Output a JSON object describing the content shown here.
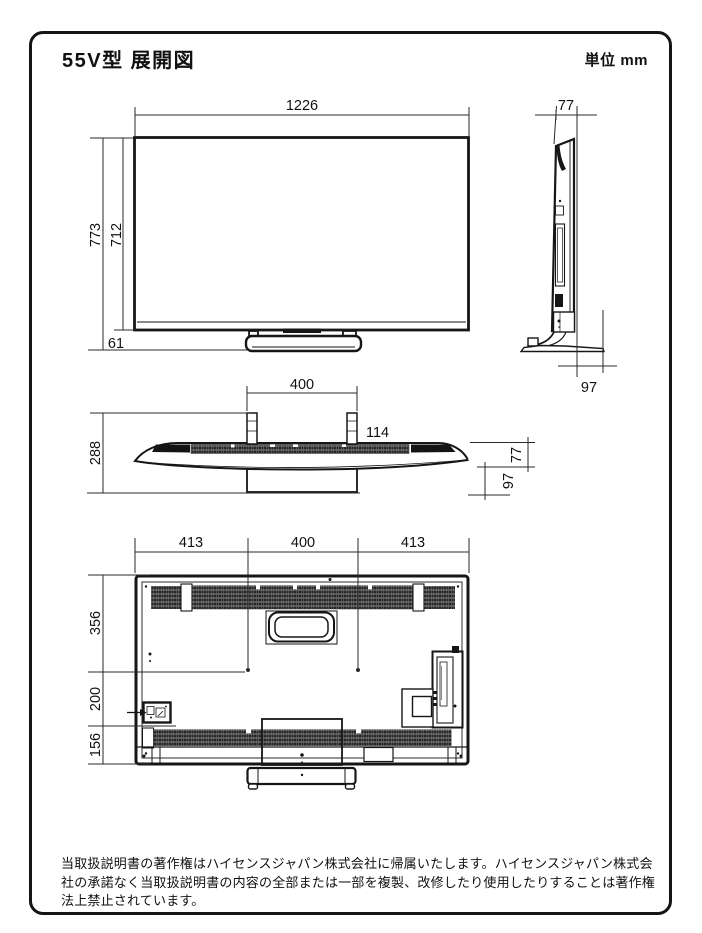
{
  "title": "55V型 展開図",
  "unit_label": "単位 mm",
  "front_view": {
    "width_mm": "1226",
    "total_height_mm": "773",
    "screen_height_mm": "712",
    "stand_gap_mm": "61"
  },
  "side_view": {
    "depth_mm": "77",
    "base_depth_mm": "97"
  },
  "top_view": {
    "stand_width_mm": "400",
    "total_depth_mm": "288",
    "neck_offset_mm": "114",
    "panel_depth_mm": "77",
    "base_rear_mm": "97"
  },
  "back_view": {
    "span_left_mm": "413",
    "span_center_mm": "400",
    "span_right_mm": "413",
    "upper_height_mm": "356",
    "middle_height_mm": "200",
    "lower_height_mm": "156"
  },
  "footer": {
    "lines": [
      "当取扱説明書の著作権はハイセンスジャパン株式会社に帰属いたします。ハイセンスジャパン株式会",
      "社の承諾なく当取扱説明書の内容の全部または一部を複製、改修したり使用したりすることは著作権",
      "法上禁止されています。"
    ]
  }
}
